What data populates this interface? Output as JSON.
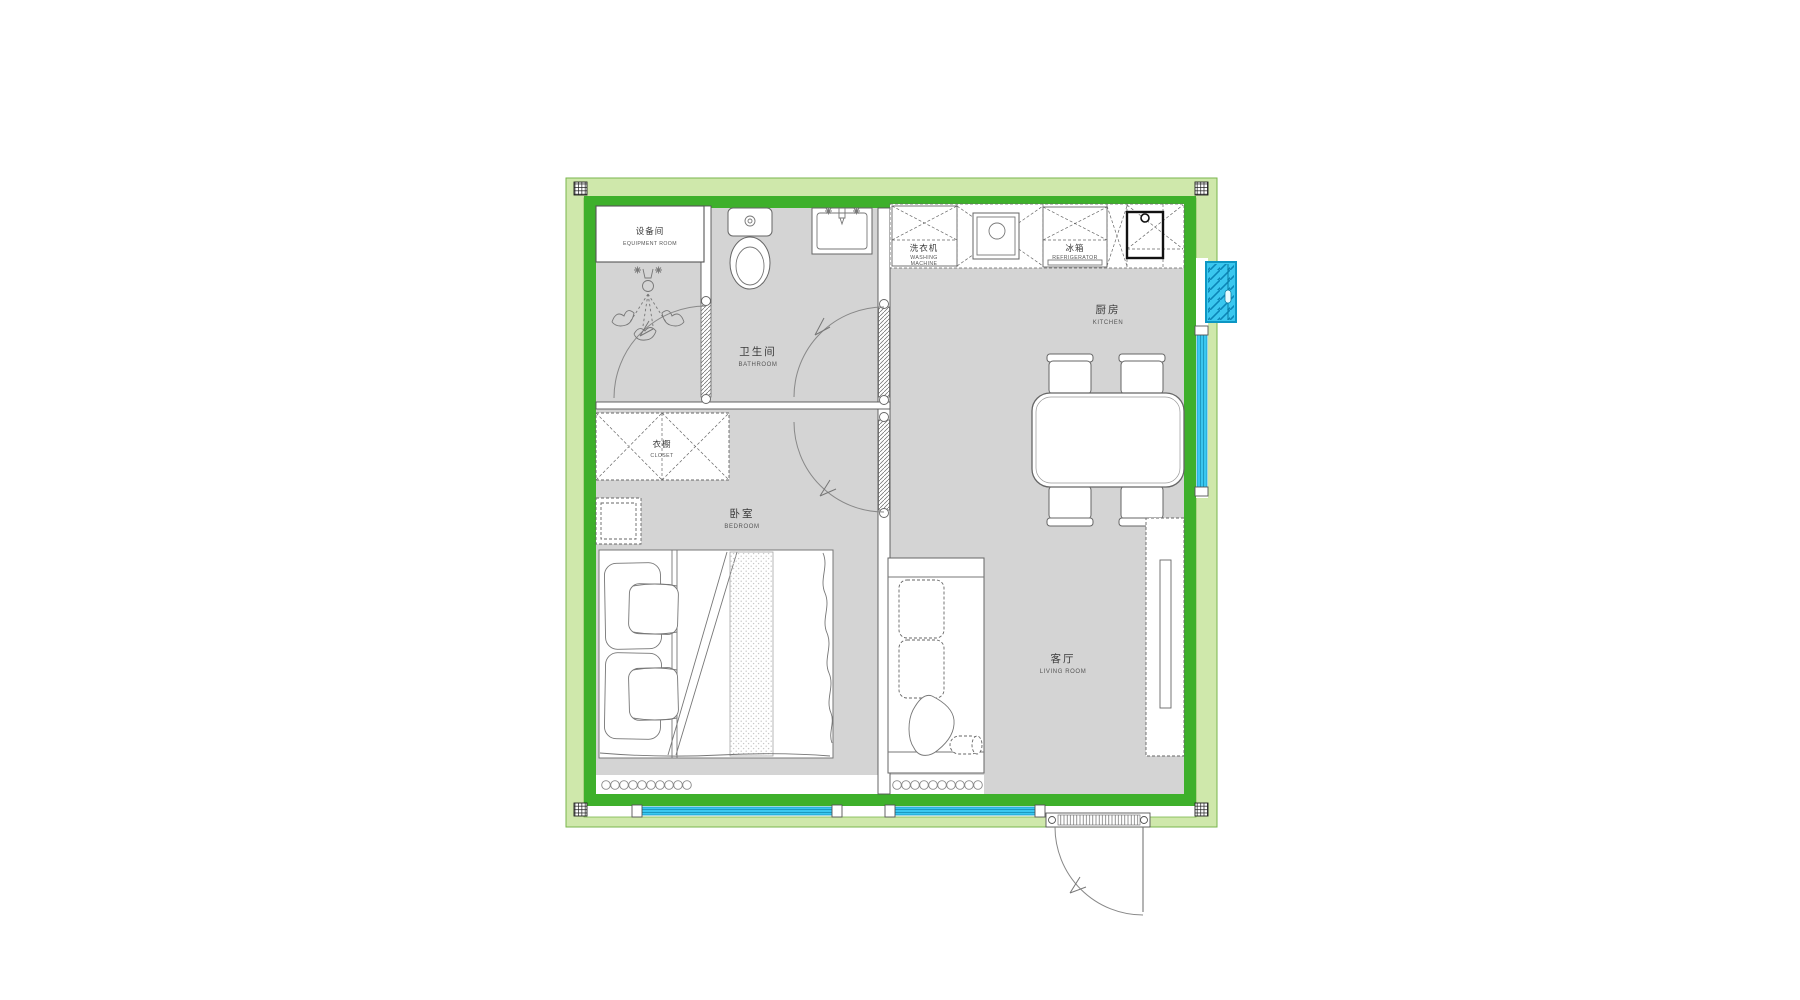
{
  "plan": {
    "rooms": {
      "equipment_room": {
        "zh": "设备间",
        "en": "EQUIPMENT ROOM"
      },
      "bathroom": {
        "zh": "卫生间",
        "en": "BATHROOM"
      },
      "closet": {
        "zh": "衣橱",
        "en": "CLOSET"
      },
      "bedroom": {
        "zh": "卧室",
        "en": "BEDROOM"
      },
      "kitchen": {
        "zh": "厨房",
        "en": "KITCHEN"
      },
      "living_room": {
        "zh": "客厅",
        "en": "LIVING ROOM"
      }
    },
    "appliances": {
      "washing_machine": {
        "zh": "洗衣机",
        "en_line1": "WASHING",
        "en_line2": "MACHINE"
      },
      "refrigerator": {
        "zh": "冰箱",
        "en": "REFRIGERATOR"
      }
    },
    "colors": {
      "wall_green": "#3eb02b",
      "band_green": "#cfe8ab",
      "band_edge": "#7ab64c",
      "window_cyan": "#3ac7ef",
      "window_edge": "#0d96c3",
      "floor_gray": "#d4d4d4"
    }
  }
}
